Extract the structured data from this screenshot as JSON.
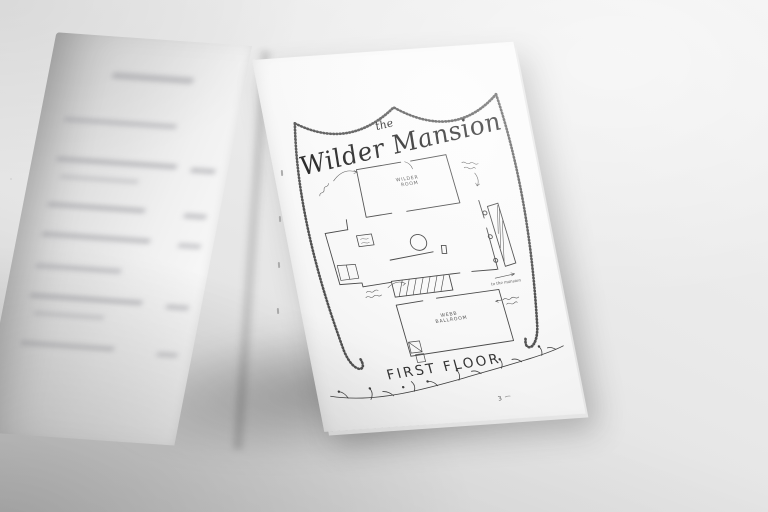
{
  "photo": {
    "background_color": "#e9e9e9",
    "paper_color": "#fbfbfb",
    "ink_color": "#3a3a3a",
    "subject": "open hand-drawn wedding program booklet"
  },
  "right_page": {
    "title": {
      "prefix": "the",
      "name": "Wilder Mansion"
    },
    "floor_plan": {
      "rooms": [
        {
          "name": "WILDER ROOM",
          "lines": [
            "WILDER",
            "ROOM"
          ]
        },
        {
          "name": "WEBB BALLROOM",
          "lines": [
            "WEBB",
            "BALLROOM"
          ]
        }
      ],
      "annotation_to_mansion": "to the mansion"
    },
    "caption": "FIRST FLOOR",
    "page_number": "3"
  }
}
